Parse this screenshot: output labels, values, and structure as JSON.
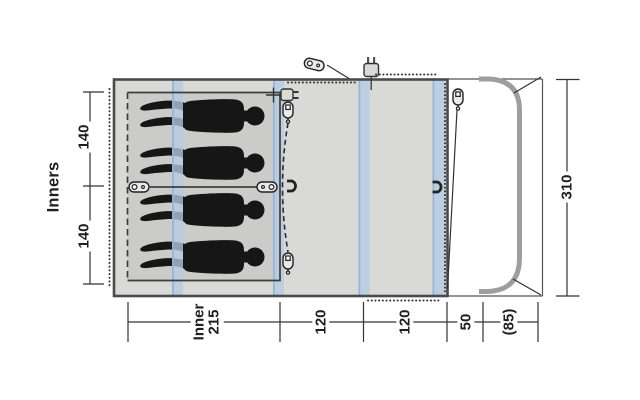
{
  "diagram_type": "tent-floorplan-top-view",
  "colors": {
    "body": "#d9d9d8",
    "inner": "#cbcbca",
    "pole": "#b5cae3",
    "pole_edge": "#92b0d6",
    "outline": "#4a4a4a",
    "line": "#333333",
    "person": "#161616",
    "frame": "#9e9e9e",
    "text": "#1f1f1f"
  },
  "dimension_labels": {
    "inners_title": "Inners",
    "left_upper": "140",
    "left_lower": "140",
    "right_depth": "310",
    "bottom_inner_line1": "Inner",
    "bottom_inner_line2": "215",
    "bottom_living_left": "120",
    "bottom_living_right": "120",
    "bottom_front": "50",
    "bottom_awning": "(85)"
  },
  "icons": {
    "zipper_pull": "zipper-pull-icon",
    "power_plug": "power-plug-icon",
    "toggle_hook": "toggle-hook-icon",
    "person": "person-silhouette"
  }
}
